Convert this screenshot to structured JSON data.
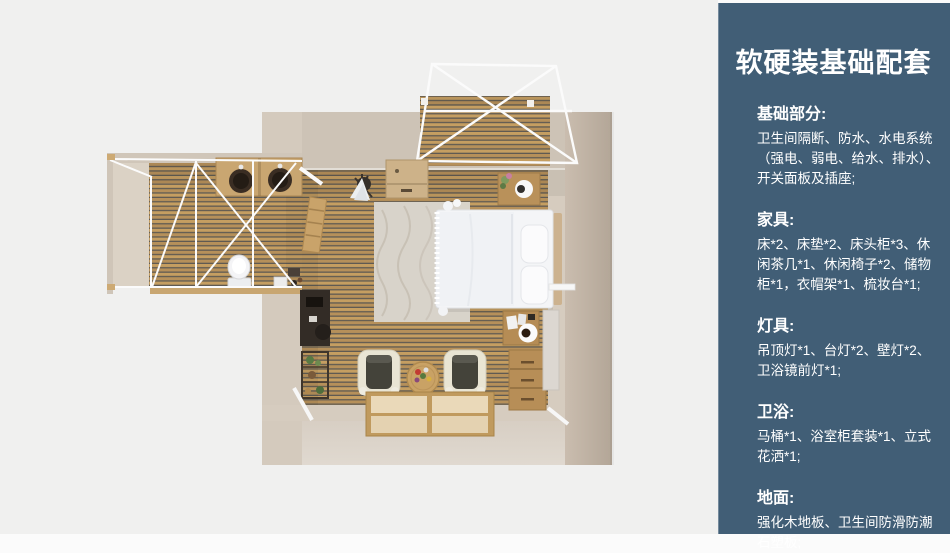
{
  "panel": {
    "title": "软硬装基础配套",
    "sections": [
      {
        "heading": "基础部分:",
        "body": "卫生间隔断、防水、水电系统\n（强电、弱电、给水、排水）、\n开关面板及插座;"
      },
      {
        "heading": "家具:",
        "body": "床*2、床垫*2、床头柜*3、休\n闲茶几*1、休闲椅子*2、储物\n柜*1，衣帽架*1、梳妆台*1;"
      },
      {
        "heading": "灯具:",
        "body": "吊顶灯*1、台灯*2、壁灯*2、\n卫浴镜前灯*1;"
      },
      {
        "heading": "卫浴:",
        "body": "马桶*1、浴室柜套装*1、立式\n花洒*1;"
      },
      {
        "heading": "地面:",
        "body": "强化木地板、卫生间防滑防潮\n石塑板;"
      }
    ]
  },
  "floorplan": {
    "alt": "顶视3D渲染图：主卧室（双人床、床头柜、休闲椅*2、茶几、梳妆台、储物柜、衣帽架）、卫生间（双盆浴室柜、马桶）、木平台阳台"
  },
  "colors": {
    "canvas_bg": "#f0f0ef",
    "sidebar_bg": "#415e76",
    "sidebar_text": "#ffffff",
    "wood_plank": "#c59e61",
    "wood_plank2": "#b6905a",
    "wood_groove": "#5f5a52",
    "wall_beige": "#cdc3b6",
    "wall_light": "#d6ccbf",
    "wall_front": "#dcd4c9",
    "wall_right": "#bcafa0",
    "frame_white": "#fafafa",
    "bed_white": "#f4f5f7"
  }
}
